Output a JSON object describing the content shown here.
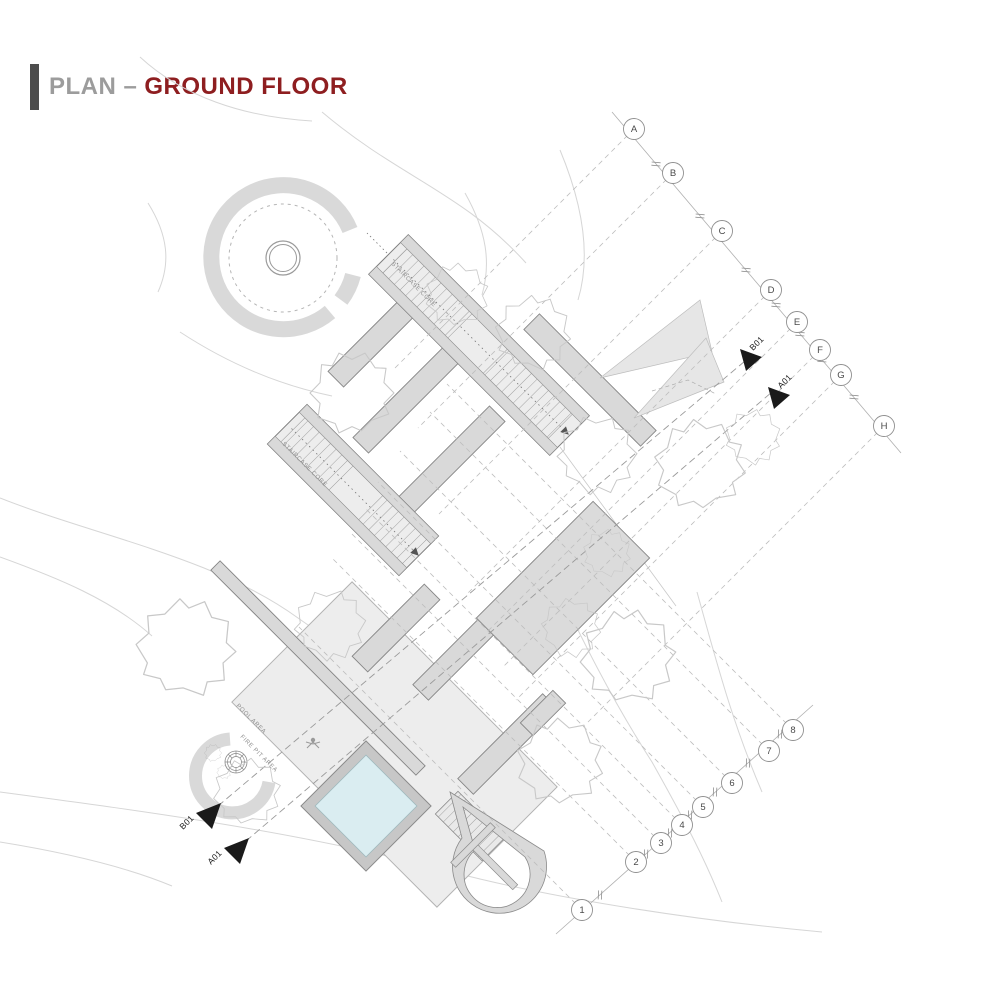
{
  "title": {
    "prefix": "PLAN –",
    "highlight": "GROUND FLOOR"
  },
  "colors": {
    "accent": "#8E1E20",
    "title_gray": "#9C9C9C",
    "wall_fill": "#D9D9D9",
    "deck_fill": "#EDEDED",
    "pool_water": "#DAEDF1",
    "marker_black": "#1A1A1A"
  },
  "plan": {
    "grid": {
      "letters": [
        "A",
        "B",
        "C",
        "D",
        "E",
        "F",
        "G",
        "H"
      ],
      "numbers": [
        "1",
        "2",
        "3",
        "4",
        "5",
        "6",
        "7",
        "8"
      ]
    },
    "section_markers": {
      "top_b": "B01",
      "top_a": "A01",
      "bottom_b": "B01",
      "bottom_a": "A01"
    },
    "area_labels": {
      "stair_core_1": "STAIRCASE CORE",
      "stair_core_2": "STAIRCASE CORE",
      "pool_area": "POOL AREA",
      "fire_pit_area": "FIRE PIT AREA"
    }
  }
}
